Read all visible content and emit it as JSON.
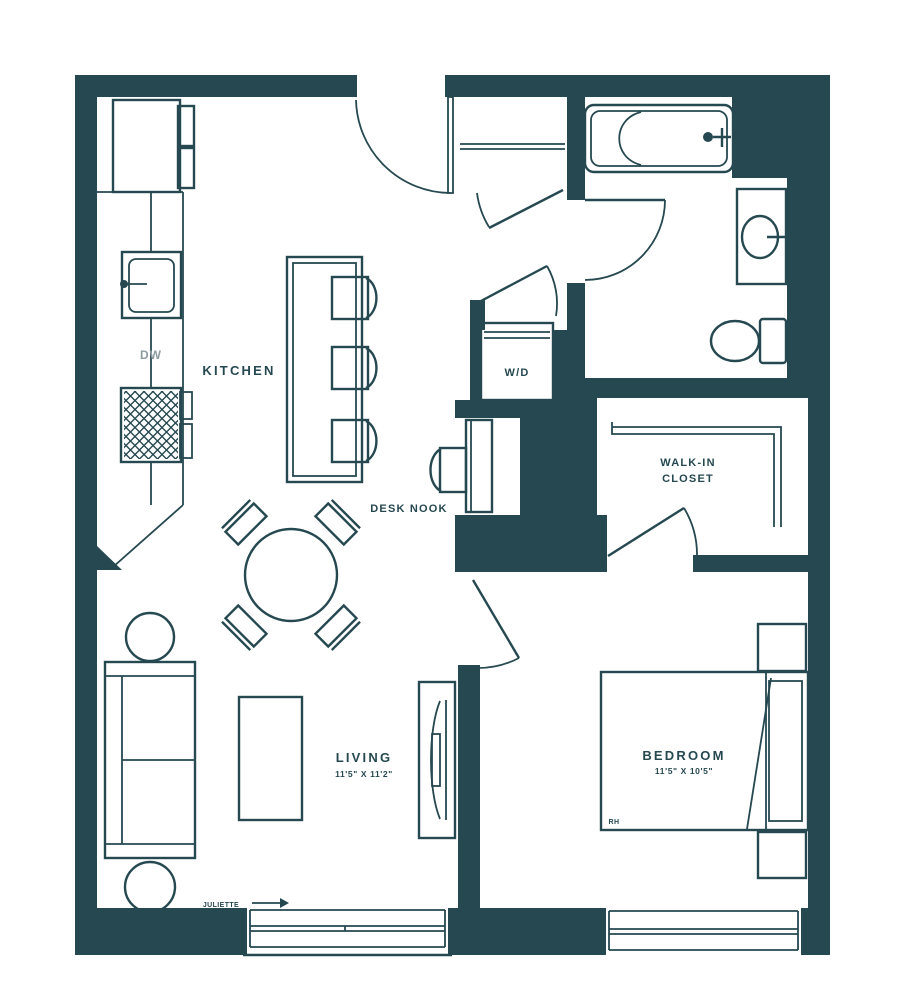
{
  "labels": {
    "kitchen": "KITCHEN",
    "dw": "DW",
    "wd": "W/D",
    "walk_in_line1": "WALK-IN",
    "walk_in_line2": "CLOSET",
    "desk_nook": "DESK NOOK",
    "living": "LIVING",
    "living_dims": "11'5\" X 11'2\"",
    "bedroom": "BEDROOM",
    "bedroom_dims": "11'5\" X 10'5\"",
    "bed_brand": "RH",
    "juliette": "JULIETTE"
  },
  "colors": {
    "wall": "#264850",
    "muted_text": "#8d9ca1",
    "background": "#ffffff"
  }
}
